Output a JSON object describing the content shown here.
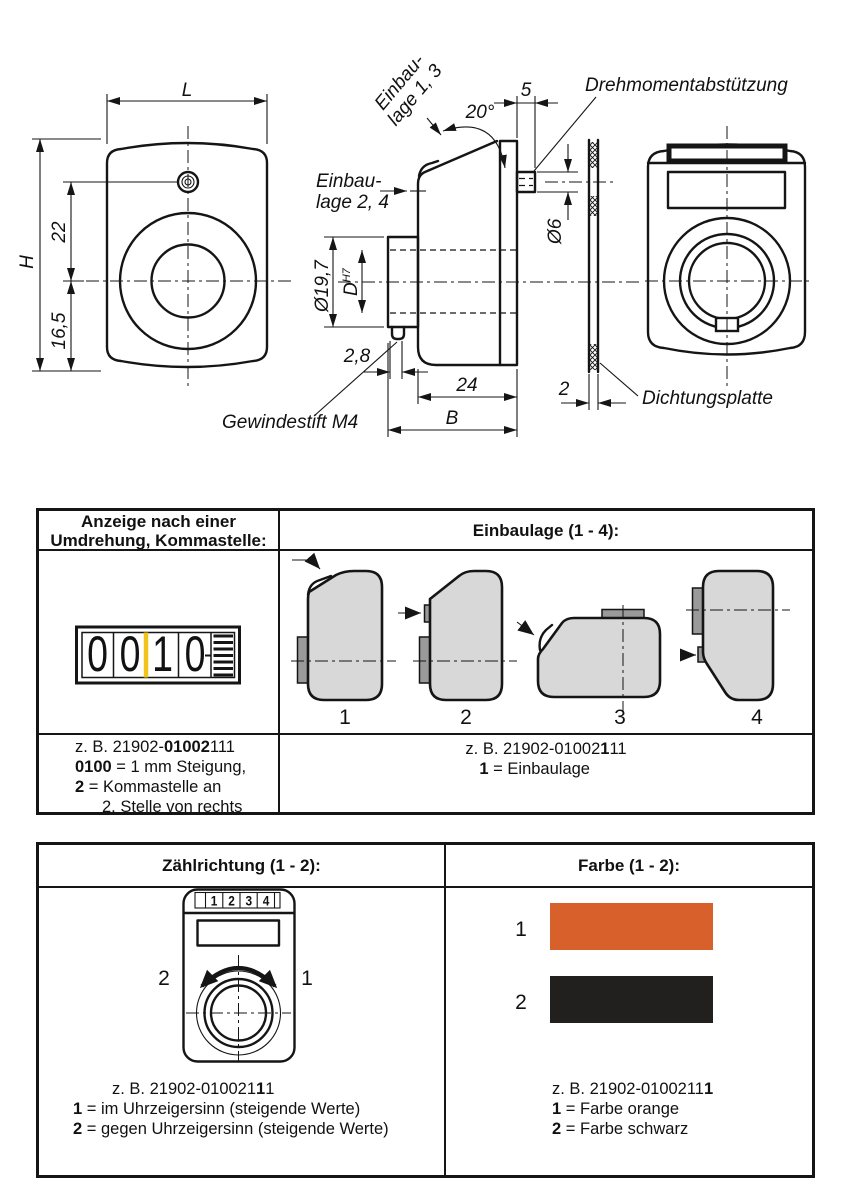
{
  "colors": {
    "line": "#151515",
    "body_gray": "#d8d8d8",
    "tab_gray": "#9a9a9a",
    "marker_yellow": "#f0c41b",
    "swatch_orange": "#d7602b",
    "swatch_black": "#21201e"
  },
  "drawing": {
    "front_view": {
      "dim_L": "L",
      "dim_H": "H",
      "dim_22": "22",
      "dim_16_5": "16,5"
    },
    "side_view": {
      "label_einbaulage13_l1": "Einbau-",
      "label_einbaulage13_l2": "lage 1, 3",
      "label_einbaulage24_l1": "Einbau-",
      "label_einbaulage24_l2": "lage 2, 4",
      "dim_angle": "20°",
      "dim_5": "5",
      "dim_dia6": "Ø6",
      "dim_dia19_7": "Ø19,7",
      "dim_D": "D",
      "dim_D_tol": "H7",
      "dim_2_8": "2,8",
      "dim_24": "24",
      "dim_B": "B",
      "label_gewindestift": "Gewindestift M4"
    },
    "seal_view": {
      "label_drehmoment": "Drehmomentabstützung",
      "label_dichtungsplatte": "Dichtungsplatte",
      "dim_2": "2"
    }
  },
  "table1": {
    "header_left_l1": "Anzeige nach einer",
    "header_left_l2": "Umdrehung, Kommastelle:",
    "header_right": "Einbaulage (1 - 4):",
    "counter": {
      "digits": [
        "0",
        "0",
        "1",
        "0"
      ]
    },
    "positions": [
      "1",
      "2",
      "3",
      "4"
    ],
    "left_code": {
      "p1": "z. B. 21902-",
      "b1": "01002",
      "p2": "111"
    },
    "left_l2": {
      "b": "0100",
      "r": " = 1 mm Steigung,"
    },
    "left_l3": {
      "b": "2",
      "r": " = Kommastelle an"
    },
    "left_l4": "2. Stelle von rechts",
    "right_code": {
      "p1": "z. B. 21902-01002",
      "b1": "1",
      "p2": "11"
    },
    "right_l2": {
      "b": "1",
      "r": " = Einbaulage"
    }
  },
  "table2": {
    "header_left": "Zählrichtung (1 - 2):",
    "header_right": "Farbe (1 - 2):",
    "dial": {
      "digits": [
        "1",
        "2",
        "3",
        "4"
      ],
      "left_label": "2",
      "right_label": "1"
    },
    "colors": [
      {
        "label": "1",
        "name": "orange",
        "hex": "#d7602b"
      },
      {
        "label": "2",
        "name": "schwarz",
        "hex": "#21201e"
      }
    ],
    "left_code": {
      "p1": "z. B. 21902-010021",
      "b1": "1",
      "p2": "1"
    },
    "left_l2": {
      "b": "1",
      "r": " = im Uhrzeigersinn (steigende Werte)"
    },
    "left_l3": {
      "b": "2",
      "r": " = gegen Uhrzeigersinn (steigende Werte)"
    },
    "right_code": {
      "p1": "z. B. 21902-0100211",
      "b1": "1"
    },
    "right_l2": {
      "b": "1",
      "r": " = Farbe orange"
    },
    "right_l3": {
      "b": "2",
      "r": " = Farbe schwarz"
    }
  }
}
